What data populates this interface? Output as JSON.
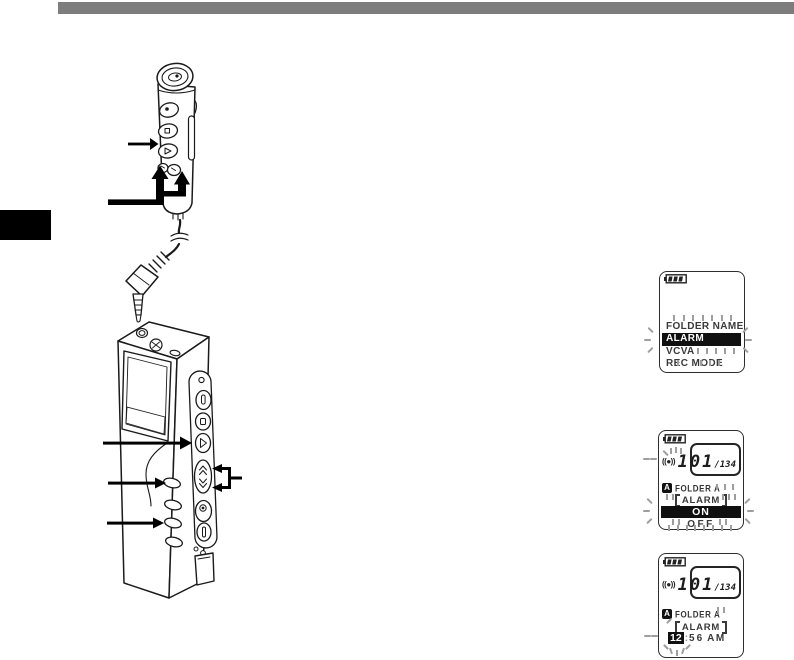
{
  "page": {
    "background_color": "#ffffff",
    "top_rule_color": "#7d7d7d",
    "chapter_tab_color": "#000000"
  },
  "figure": {
    "parts": {
      "remote": "remote-controller-with-microphone",
      "cable": "connection-cord",
      "plug": "right-angle-plug",
      "recorder": "digital-voice-recorder",
      "callouts": [
        "remote-play-button-arrow",
        "remote-ff-rew-buttons-arrow",
        "recorder-play-button-arrow",
        "recorder-folder-button-arrow",
        "recorder-menu-button-arrow",
        "recorder-ff-rew-buttons-bracket"
      ]
    }
  },
  "screens": {
    "menu": {
      "battery_icon": "battery-level-3-bars",
      "items": [
        {
          "label": "FOLDER NAME",
          "selected": false
        },
        {
          "label": "ALARM",
          "selected": true
        },
        {
          "label": "VCVA",
          "selected": false
        },
        {
          "label": "REC MODE",
          "selected": false
        }
      ]
    },
    "alarm_on_off": {
      "battery_icon": "battery-level-3-bars",
      "alarm_icon": "((●))",
      "file_number": "101",
      "file_total": "/134",
      "folder_badge": "A",
      "folder_name": "FOLDER A",
      "setting_title": "【ALARM】",
      "setting_title_text": "ALARM",
      "options": [
        {
          "label": "ON",
          "selected": true
        },
        {
          "label": "OFF",
          "selected": false
        }
      ]
    },
    "alarm_time": {
      "battery_icon": "battery-level-3-bars",
      "alarm_icon": "((●))",
      "file_number": "101",
      "file_total": "/134",
      "folder_badge": "A",
      "folder_name": "FOLDER A",
      "setting_title": "【ALARM】",
      "setting_title_text": "ALARM",
      "time": {
        "hour": "12",
        "separator": ":",
        "minutes": "56",
        "ampm": "AM"
      }
    }
  }
}
